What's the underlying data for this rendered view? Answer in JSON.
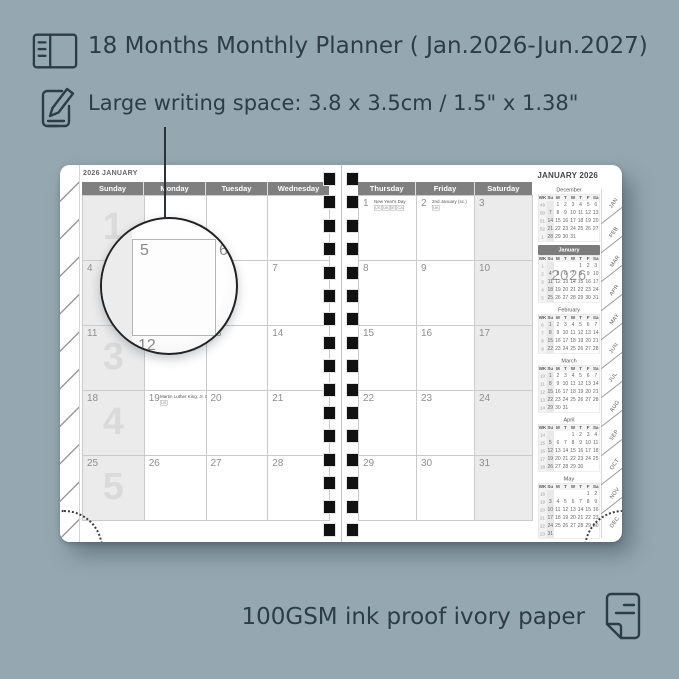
{
  "colors": {
    "background": "#95a8b2",
    "ink": "#2d3c46",
    "page": "#ffffff",
    "day_header_bar": "#7f7f7f",
    "shaded_column": "#ebebeb",
    "grid_line": "#cbcbcb",
    "binding_hole": "#111111"
  },
  "icons": {
    "book": "notebook-icon",
    "edit": "edit-note-icon",
    "paper": "paper-sheet-icon"
  },
  "header": {
    "line1": "18 Months Monthly Planner ( Jan.2026-Jun.2027)",
    "line2": "Large writing space: 3.8 x 3.5cm / 1.5\" x 1.38\""
  },
  "footer": {
    "text": "100GSM ink proof ivory paper"
  },
  "planner": {
    "left_page": {
      "title": "2026 JANUARY",
      "day_headers": [
        "Sunday",
        "Monday",
        "Tuesday",
        "Wednesday"
      ],
      "week_watermarks": [
        "1",
        "2",
        "3",
        "4",
        "5"
      ],
      "weeks": [
        {
          "cells": [
            {
              "date": ""
            },
            {
              "date": ""
            },
            {
              "date": ""
            },
            {
              "date": ""
            }
          ]
        },
        {
          "cells": [
            {
              "date": "4"
            },
            {
              "date": "5"
            },
            {
              "date": "6"
            },
            {
              "date": "7"
            }
          ]
        },
        {
          "cells": [
            {
              "date": "11"
            },
            {
              "date": "12"
            },
            {
              "date": "13"
            },
            {
              "date": "14"
            }
          ]
        },
        {
          "cells": [
            {
              "date": "18"
            },
            {
              "date": "19",
              "note": "Martin Luther King, Jr. Day",
              "codes": [
                "US"
              ]
            },
            {
              "date": "20"
            },
            {
              "date": "21"
            }
          ]
        },
        {
          "cells": [
            {
              "date": "25"
            },
            {
              "date": "26"
            },
            {
              "date": "27"
            },
            {
              "date": "28"
            }
          ]
        }
      ]
    },
    "right_page": {
      "title": "JANUARY 2026",
      "day_headers": [
        "Thursday",
        "Friday",
        "Saturday"
      ],
      "weeks": [
        {
          "cells": [
            {
              "date": "1",
              "note": "New Year's Day",
              "codes": [
                "US",
                "UK",
                "IE",
                "CA"
              ]
            },
            {
              "date": "2",
              "note": "2nd January (sc.)",
              "codes": [
                "UK"
              ]
            },
            {
              "date": "3"
            }
          ]
        },
        {
          "cells": [
            {
              "date": "8"
            },
            {
              "date": "9"
            },
            {
              "date": "10"
            }
          ]
        },
        {
          "cells": [
            {
              "date": "15"
            },
            {
              "date": "16"
            },
            {
              "date": "17"
            }
          ]
        },
        {
          "cells": [
            {
              "date": "22"
            },
            {
              "date": "23"
            },
            {
              "date": "24"
            }
          ]
        },
        {
          "cells": [
            {
              "date": "29"
            },
            {
              "date": "30"
            },
            {
              "date": "31"
            }
          ]
        }
      ]
    },
    "mini_header": [
      "WK",
      "Su",
      "M",
      "T",
      "W",
      "T",
      "F",
      "Sa"
    ],
    "mini_calendars": [
      {
        "name": "December",
        "rows": [
          [
            "49",
            "",
            "1",
            "2",
            "3",
            "4",
            "5",
            "6"
          ],
          [
            "50",
            "7",
            "8",
            "9",
            "10",
            "11",
            "12",
            "13"
          ],
          [
            "51",
            "14",
            "15",
            "16",
            "17",
            "18",
            "19",
            "20"
          ],
          [
            "52",
            "21",
            "22",
            "23",
            "24",
            "25",
            "26",
            "27"
          ],
          [
            "1",
            "28",
            "29",
            "30",
            "31",
            "",
            "",
            ""
          ]
        ]
      },
      {
        "name": "January",
        "highlight": true,
        "watermark": "2026",
        "rows": [
          [
            "1",
            "",
            "",
            "",
            "",
            "1",
            "2",
            "3"
          ],
          [
            "2",
            "4",
            "5",
            "6",
            "7",
            "8",
            "9",
            "10"
          ],
          [
            "3",
            "11",
            "12",
            "13",
            "14",
            "15",
            "16",
            "17"
          ],
          [
            "4",
            "18",
            "19",
            "20",
            "21",
            "22",
            "23",
            "24"
          ],
          [
            "5",
            "25",
            "26",
            "27",
            "28",
            "29",
            "30",
            "31"
          ]
        ]
      },
      {
        "name": "February",
        "rows": [
          [
            "6",
            "1",
            "2",
            "3",
            "4",
            "5",
            "6",
            "7"
          ],
          [
            "7",
            "8",
            "9",
            "10",
            "11",
            "12",
            "13",
            "14"
          ],
          [
            "8",
            "15",
            "16",
            "17",
            "18",
            "19",
            "20",
            "21"
          ],
          [
            "9",
            "22",
            "23",
            "24",
            "25",
            "26",
            "27",
            "28"
          ]
        ]
      },
      {
        "name": "March",
        "rows": [
          [
            "10",
            "1",
            "2",
            "3",
            "4",
            "5",
            "6",
            "7"
          ],
          [
            "11",
            "8",
            "9",
            "10",
            "11",
            "12",
            "13",
            "14"
          ],
          [
            "12",
            "15",
            "16",
            "17",
            "18",
            "19",
            "20",
            "21"
          ],
          [
            "13",
            "22",
            "23",
            "24",
            "25",
            "26",
            "27",
            "28"
          ],
          [
            "14",
            "29",
            "30",
            "31",
            "",
            "",
            "",
            ""
          ]
        ]
      },
      {
        "name": "April",
        "rows": [
          [
            "14",
            "",
            "",
            "",
            "1",
            "2",
            "3",
            "4"
          ],
          [
            "15",
            "5",
            "6",
            "7",
            "8",
            "9",
            "10",
            "11"
          ],
          [
            "16",
            "12",
            "13",
            "14",
            "15",
            "16",
            "17",
            "18"
          ],
          [
            "17",
            "19",
            "20",
            "21",
            "22",
            "23",
            "24",
            "25"
          ],
          [
            "18",
            "26",
            "27",
            "28",
            "29",
            "30",
            "",
            ""
          ]
        ]
      },
      {
        "name": "May",
        "rows": [
          [
            "18",
            "",
            "",
            "",
            "",
            "",
            "1",
            "2"
          ],
          [
            "19",
            "3",
            "4",
            "5",
            "6",
            "7",
            "8",
            "9"
          ],
          [
            "20",
            "10",
            "11",
            "12",
            "13",
            "14",
            "15",
            "16"
          ],
          [
            "21",
            "17",
            "18",
            "19",
            "20",
            "21",
            "22",
            "23"
          ],
          [
            "22",
            "24",
            "25",
            "26",
            "27",
            "28",
            "29",
            "30"
          ],
          [
            "23",
            "31",
            "",
            "",
            "",
            "",
            "",
            ""
          ]
        ]
      }
    ],
    "month_tabs": [
      "JAN",
      "FEB",
      "MAR",
      "APR",
      "MAY",
      "JUN",
      "JUL",
      "AUG",
      "SEP",
      "OCT",
      "NOV",
      "DEC"
    ],
    "binding": {
      "holes_per_column": 16
    },
    "magnifier": {
      "date": "5",
      "right_date": "6",
      "below_date": "12"
    }
  }
}
